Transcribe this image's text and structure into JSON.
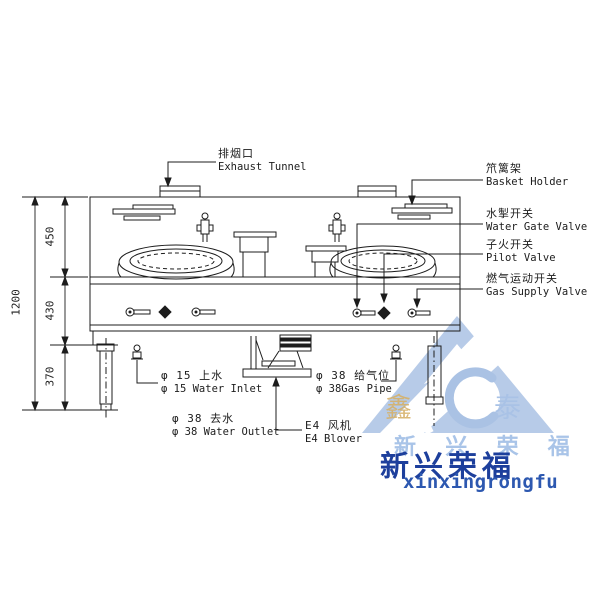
{
  "diagram_type": "kitchen-wok-range-technical-drawing",
  "labels": {
    "exhaust": {
      "zh": "排烟口",
      "en": "Exhaust Tunnel"
    },
    "basket_holder": {
      "zh": "笊篱架",
      "en": "Basket Holder"
    },
    "water_gate_valve": {
      "zh": "水掣开关",
      "en": "Water Gate Valve"
    },
    "pilot_valve": {
      "zh": "子火开关",
      "en": "Pilot Valve"
    },
    "gas_supply_valve": {
      "zh": "燃气运动开关",
      "en": "Gas Supply Valve"
    },
    "water_inlet": {
      "zh": "φ 15 上水",
      "en": "φ 15 Water Inlet"
    },
    "water_outlet": {
      "zh": "φ 38 去水",
      "en": "φ 38 Water Outlet"
    },
    "gas_pipe": {
      "zh": "φ 38 给气位",
      "en": "φ 38Gas Pipe"
    },
    "blower": {
      "zh": "E4 风机",
      "en": "E4 Blover"
    }
  },
  "dimensions": {
    "total": "1200",
    "seg_top": "450",
    "seg_mid": "430",
    "seg_bottom": "370"
  },
  "watermark": {
    "char_left": "鑫",
    "char_right": "泰",
    "brand_light": "新 兴 荣 福",
    "brand_dark": "新兴荣福",
    "brand_latin": "xinxingrongfu"
  },
  "colors": {
    "line": "#1c1c1c",
    "logo_light_blue": "#b7cbe8",
    "logo_gold": "#d6b169",
    "brand_dark_blue": "#1d3f9c",
    "brand_mid_blue": "#2d58b0"
  }
}
